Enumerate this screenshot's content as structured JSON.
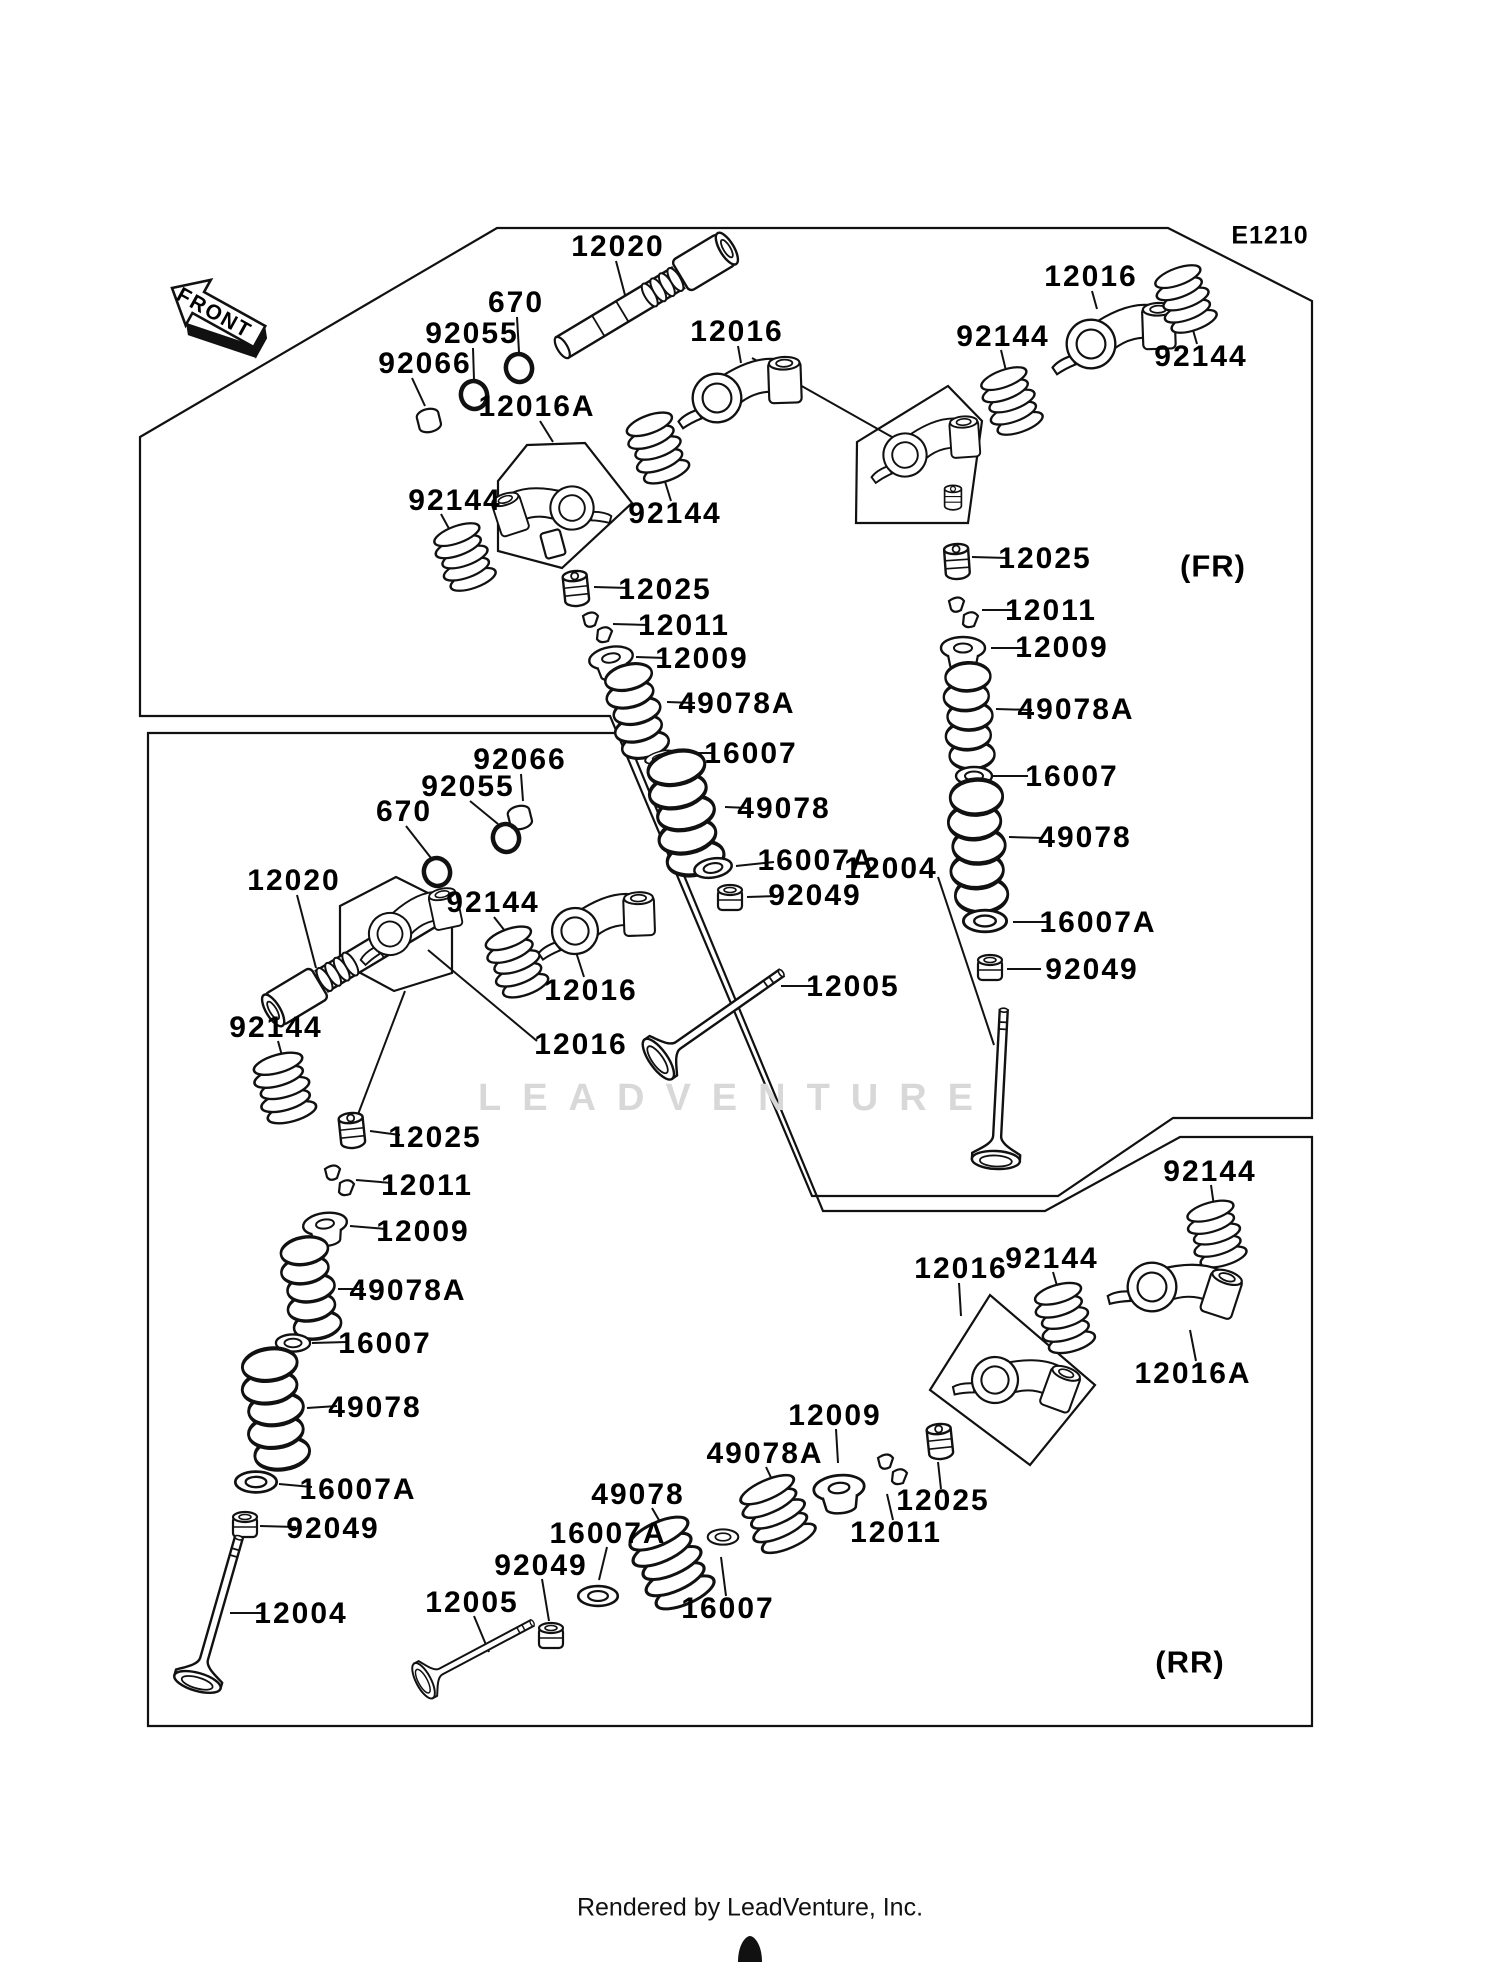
{
  "markers": {
    "diagram_code": "E1210",
    "front": "FRONT",
    "fr": "(FR)",
    "rr": "(RR)"
  },
  "branding": {
    "watermark": "LEADVENTURE",
    "footer": "Rendered by LeadVenture, Inc."
  },
  "colors": {
    "line": "#111111",
    "watermark": "#d8d8d8",
    "background": "#ffffff"
  },
  "part_labels": [
    "12020",
    "670",
    "92055",
    "92066",
    "12016A",
    "92144",
    "12016",
    "92144",
    "12016",
    "92144",
    "92144",
    "12025",
    "12011",
    "12009",
    "49078A",
    "16007",
    "49078",
    "16007A",
    "92049",
    "12004",
    "12025",
    "12011",
    "12009",
    "49078A",
    "16007",
    "49078",
    "16007A",
    "92049",
    "12005",
    "92066",
    "92055",
    "670",
    "12020",
    "92144",
    "12016",
    "12016",
    "92144",
    "12025",
    "12011",
    "12009",
    "49078A",
    "16007",
    "49078",
    "16007A",
    "92049",
    "12004",
    "12005",
    "92049",
    "16007A",
    "49078",
    "16007",
    "49078A",
    "12009",
    "12011",
    "12025",
    "12016",
    "92144",
    "92144",
    "12016A"
  ]
}
